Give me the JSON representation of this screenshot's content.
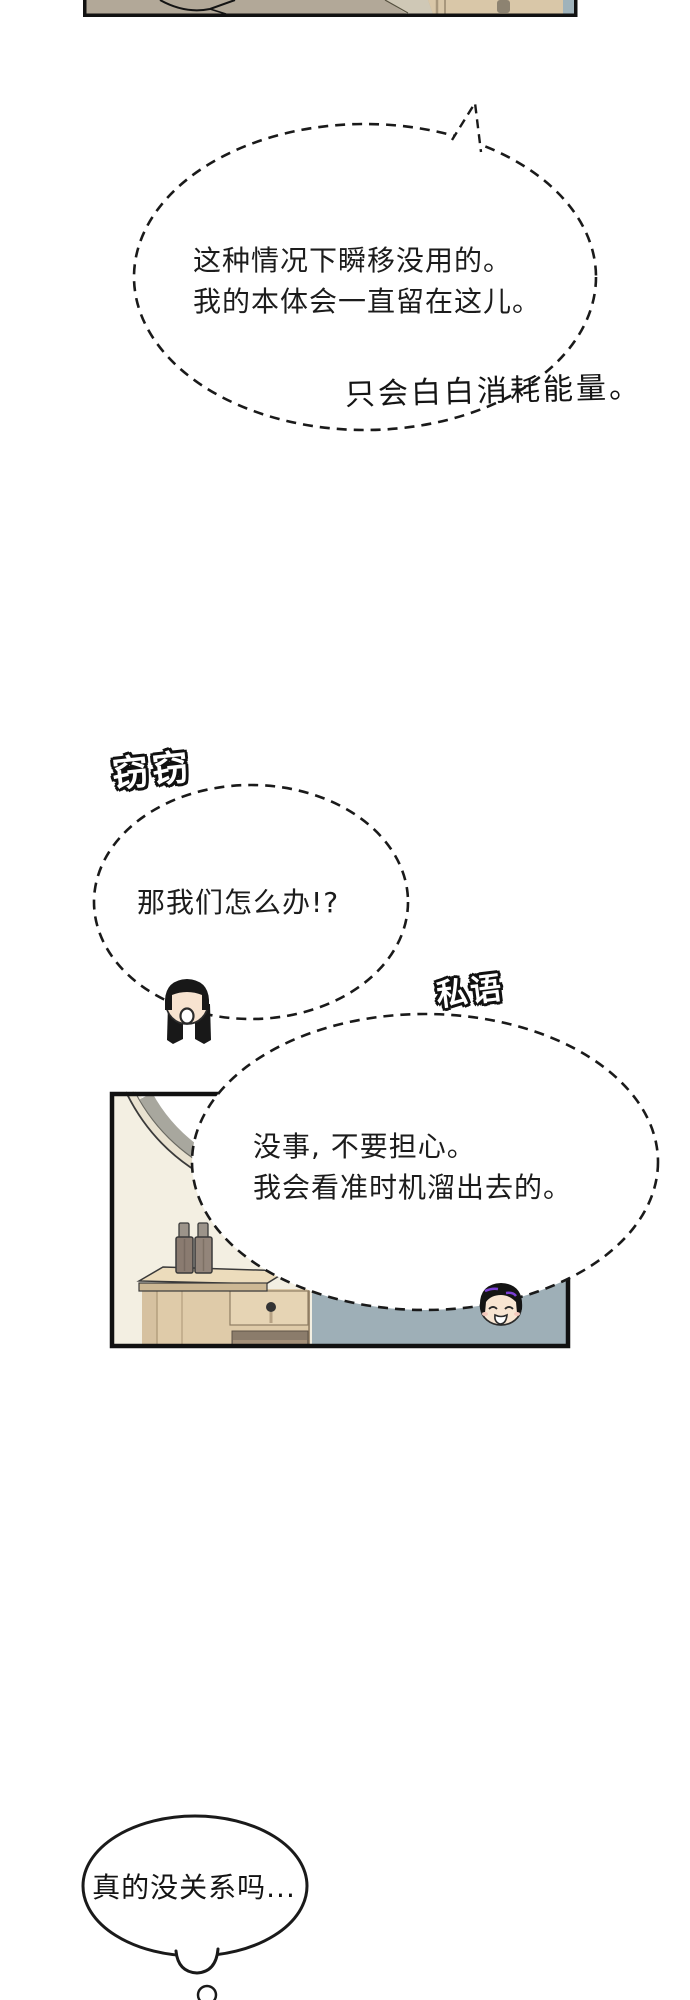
{
  "page": {
    "kind": "webtoon comic page",
    "background": "#ffffff",
    "ink_color": "#1a1a1a"
  },
  "speech": {
    "teleport": {
      "line1": "这种情况下瞬移没用的。",
      "line2": "我的本体会一直留在这儿。"
    },
    "energy_aside": "只会白白消耗能量。",
    "whisper_label_left": "窃窃",
    "what_now": "那我们怎么办!?",
    "whisper_label_right": "私语",
    "dont_worry": {
      "line1": "没事, 不要担心。",
      "line2": "我会看准时机溜出去的。"
    },
    "really_ok": "真的没关系吗..."
  },
  "bubbles": [
    {
      "id": "teleport",
      "style": "dashed ellipse with small tail top-right"
    },
    {
      "id": "what-now",
      "style": "dashed ellipse, girl head on bottom edge"
    },
    {
      "id": "dont-worry",
      "style": "dashed ellipse overlapping bedroom panel, boy head on bottom edge"
    },
    {
      "id": "really-ok",
      "style": "solid thought bubble with bottom bump and trailing circle"
    }
  ],
  "characters": {
    "girl": {
      "description": "chibi girl head: black hair, straight bangs, two pigtails, open oval mouth",
      "hair_color": "#181818",
      "skin_color": "#f7e3d0"
    },
    "boy": {
      "description": "chibi boy head peeking over bed edge: black hair with purple streaks, closed happy eyes, open grin",
      "hair_color": "#141414",
      "streak_color": "#7b3fd6",
      "skin_color": "#f8e5d2"
    }
  },
  "top_strip": {
    "description": "cropped bottom edge of previous panel",
    "colors": {
      "tan": "#b2a898",
      "light": "#cfc8b6",
      "beige": "#d9c7a8",
      "blue": "#a0b3bb"
    }
  },
  "bedroom_panel": {
    "objects": [
      "round wall mirror (partial)",
      "nightstand with drawer and open shelf",
      "two dark bottles",
      "blue-gray bed"
    ],
    "colors": {
      "wall": "#f3efe2",
      "bed": "#9eafb7",
      "wood": "#dfcba9",
      "wood_top": "#ecdcbc",
      "wood_edge": "#cdb894",
      "shelf_dark": "#8b7c6b",
      "bottle": "#8a7b70",
      "bottle_cap": "#9c948a",
      "mirror_frame": "#e9e2d0",
      "mirror_shadow": "#a8a79e"
    }
  }
}
